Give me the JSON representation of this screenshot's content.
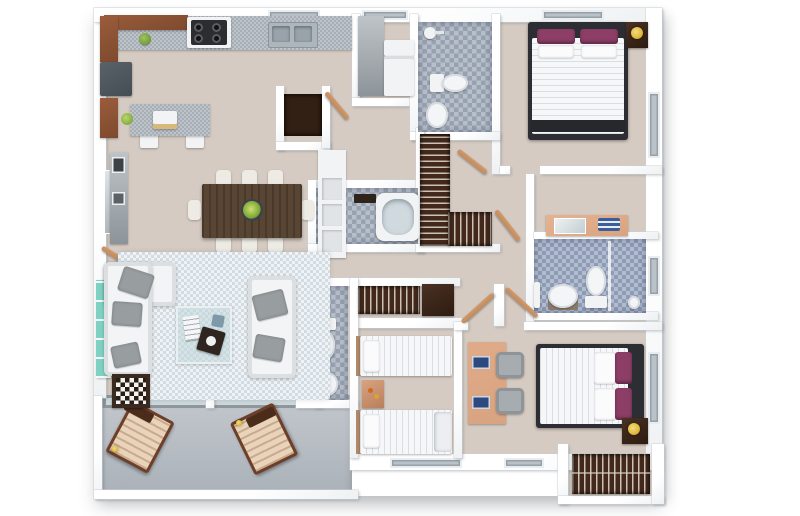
{
  "meta": {
    "kind": "3d-rendered-floor-plan",
    "view": "top-down dollhouse render of a 3-bedroom apartment",
    "visible_text": "none",
    "background": "#ffffff"
  },
  "palette": {
    "floorMain": "#d5cbc2",
    "floorBalcony": "#b9bfc5",
    "wall": "#ffffff",
    "rug": "#dde4e8",
    "tileA": "#97a1b0",
    "tileB": "#b7bfca",
    "tileBlueA": "#8e9bb4",
    "tileBlueB": "#b3bdd0",
    "granite": "#bcc3c9",
    "graniteDark": "#a7aeb5",
    "cabinetBrown": "#9a5c3c",
    "woodDoor": "#c08a5e",
    "wardrobe": "#43291b",
    "fridge": "#454d54",
    "applianceWhite": "#f2f3f4",
    "sofa": "#f3f4f5",
    "pillowGray": "#989ea0",
    "bedWhite": "#f6f7f9",
    "purple": "#8c3e66",
    "bedFrame": "#2c2e33",
    "lampYellow": "#e0ba3e",
    "tableWood": "#594534",
    "chairWhite": "#edebe4",
    "teal": "#7fd2c3",
    "loungeWood": "#6e3f28",
    "loungeCushion": "#e9d3b9",
    "deskPeach": "#d8a381",
    "matDark": "#332014"
  },
  "rooms": [
    {
      "name": "kitchen",
      "position": "top-left",
      "floor": "beige",
      "furniture": [
        "upper-cabinets",
        "granite-counter",
        "gas-stove",
        "double-sink",
        "refrigerator",
        "kitchen-island",
        "countertop-appliance",
        "green-bowl",
        "plant"
      ]
    },
    {
      "name": "laundry-nook",
      "position": "top-center",
      "furniture": [
        "tall-cabinet",
        "washer",
        "counter"
      ]
    },
    {
      "name": "entry-foyer",
      "position": "top-center",
      "furniture": [
        "dark-doormat",
        "entry-door"
      ]
    },
    {
      "name": "dining-room",
      "position": "center-left",
      "furniture": [
        "dark-wood-table",
        "eight-white-chairs",
        "centerpiece-bowl",
        "white-shelf-unit",
        "console-cabinet",
        "wall-mirror"
      ]
    },
    {
      "name": "living-room",
      "position": "left",
      "floor": "light-blue-rug",
      "furniture": [
        "l-shaped-white-sofa",
        "white-loveseat",
        "gray-throw-pillows",
        "glass-coffee-table",
        "magazines",
        "dark-serving-tray",
        "checkerboard-side-table",
        "teal-shelf"
      ]
    },
    {
      "name": "balcony",
      "position": "bottom-left",
      "floor": "gray",
      "furniture": [
        "wooden-lounge-chair",
        "wooden-lounge-chair",
        "sliding-glass-door"
      ]
    },
    {
      "name": "master-bedroom",
      "position": "top-right",
      "furniture": [
        "double-bed-white-duvet",
        "purple-pillows",
        "dark-headboard",
        "nightstand",
        "yellow-table-lamp",
        "foot-bench",
        "window"
      ]
    },
    {
      "name": "master-bathroom",
      "position": "top-center-right",
      "floor": "gray-mosaic",
      "furniture": [
        "shower",
        "toilet",
        "sink"
      ]
    },
    {
      "name": "tub-bathroom",
      "position": "center",
      "floor": "gray-mosaic",
      "furniture": [
        "bathtub",
        "dark-shelf"
      ]
    },
    {
      "name": "walk-in-closet",
      "position": "center",
      "furniture": [
        "hanging-clothes-wardrobe",
        "lower-wardrobe"
      ]
    },
    {
      "name": "hall-closet",
      "position": "center",
      "furniture": [
        "hanging-clothes-rod",
        "dark-cabinet"
      ]
    },
    {
      "name": "powder-bathroom",
      "position": "center-left",
      "floor": "gray-mosaic",
      "furniture": [
        "toilet",
        "pedestal-sink"
      ]
    },
    {
      "name": "twin-bedroom",
      "position": "bottom-center",
      "furniture": [
        "twin-bed",
        "twin-bed",
        "wood-nightstand",
        "window"
      ]
    },
    {
      "name": "third-bedroom",
      "position": "bottom-right",
      "furniture": [
        "double-bed-white-duvet",
        "purple-pillows",
        "nightstand",
        "yellow-table-lamp",
        "desk",
        "two-gray-chairs",
        "blue-laptops",
        "window"
      ]
    },
    {
      "name": "ensuite-bathroom",
      "position": "right",
      "floor": "blue-mosaic",
      "furniture": [
        "vanity-with-mirror",
        "blue-towels",
        "toilet",
        "bowl-sink",
        "shower-partition"
      ]
    },
    {
      "name": "closet-nook",
      "position": "bottom-right",
      "furniture": [
        "hanging-clothes-wardrobe"
      ]
    }
  ]
}
